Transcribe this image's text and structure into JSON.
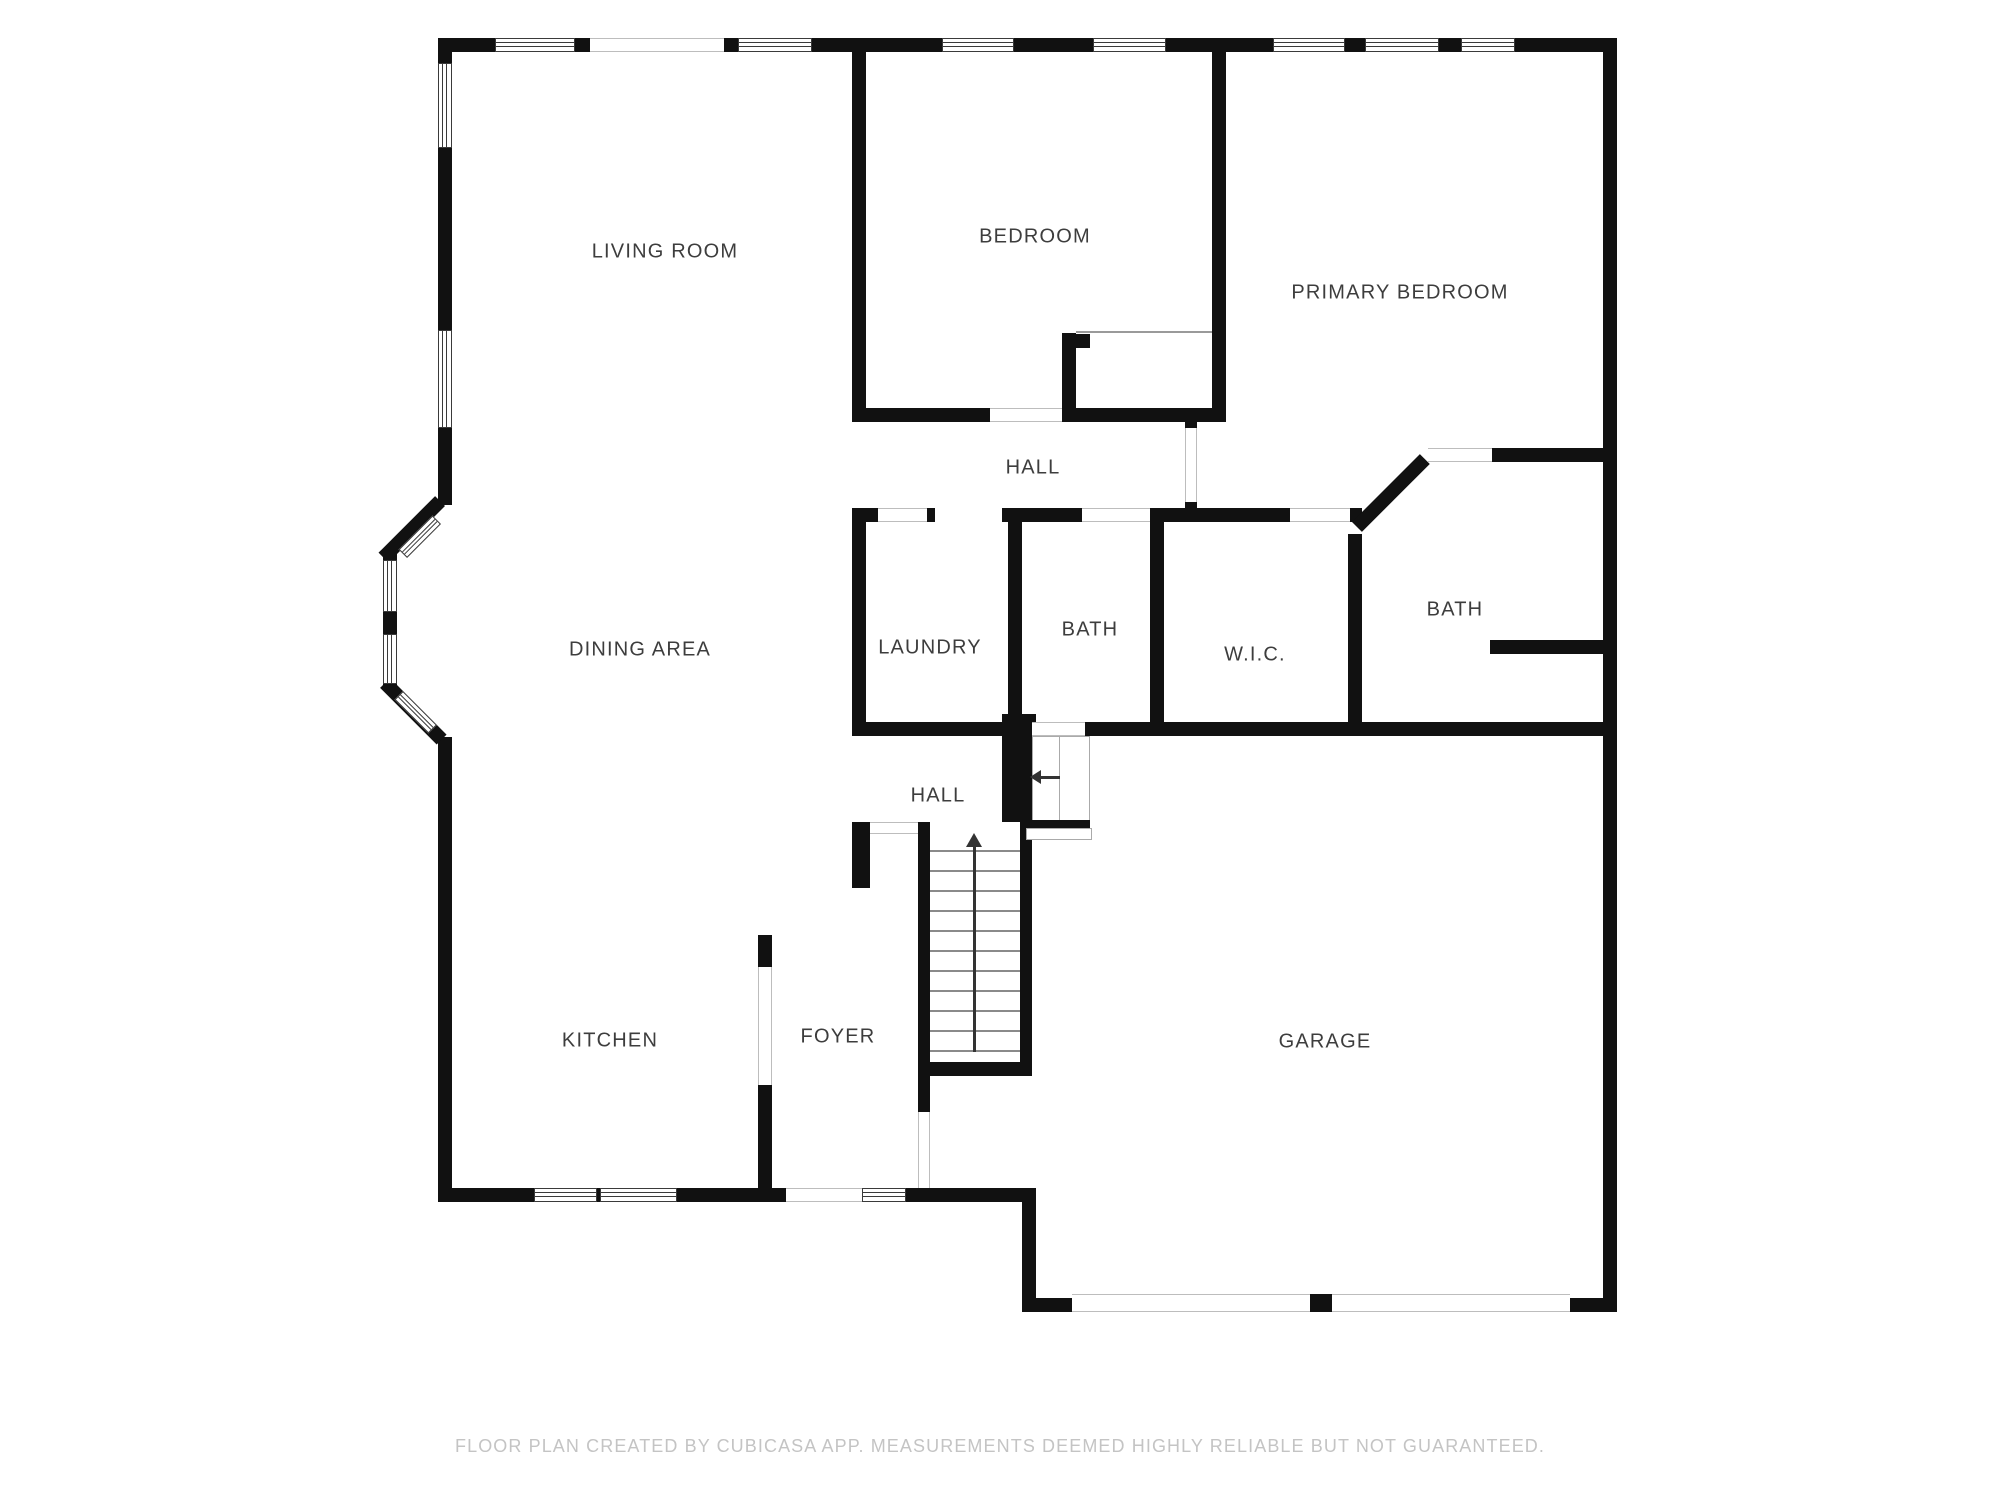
{
  "floor_plan": {
    "rooms": {
      "living_room": "LIVING ROOM",
      "bedroom": "BEDROOM",
      "primary_bedroom": "PRIMARY BEDROOM",
      "hall_upper": "HALL",
      "laundry": "LAUNDRY",
      "bath_middle": "BATH",
      "wic": "W.I.C.",
      "bath_right": "BATH",
      "dining_area": "DINING AREA",
      "hall_lower": "HALL",
      "kitchen": "KITCHEN",
      "foyer": "FOYER",
      "garage": "GARAGE"
    },
    "footer": "FLOOR PLAN CREATED BY CUBICASA APP. MEASUREMENTS DEEMED HIGHLY RELIABLE BUT NOT GUARANTEED.",
    "icons": {
      "stairs_up_arrow": "stairs-up-arrow",
      "stairs_left_arrow": "stairs-left-arrow"
    },
    "colors": {
      "wall": "#111111",
      "room_label": "#3d3d3d",
      "footer_text": "#c4c4c4",
      "window_frame": "#3a3a3a",
      "opening_line": "#bdbdbd",
      "background": "#ffffff"
    }
  }
}
